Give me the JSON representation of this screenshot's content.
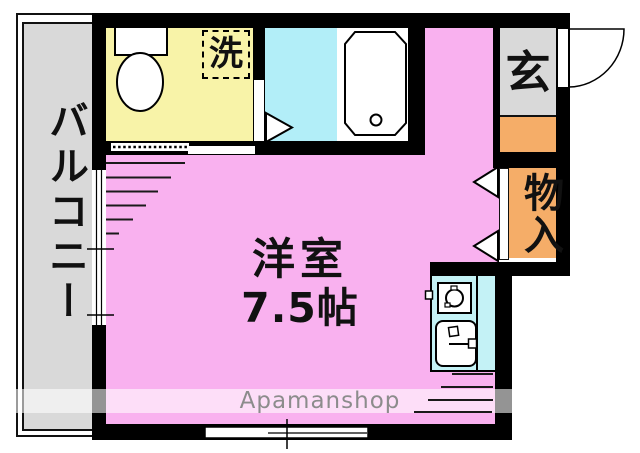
{
  "floorplan": {
    "balcony_label": "バルコニー",
    "laundry_label": "洗",
    "entrance_label": "玄",
    "closet_label": "物入",
    "room_label": "洋室",
    "room_size_label": "7.5帖",
    "watermark_label": "Apamanshop",
    "colors": {
      "room_pink": "#f9b1ef",
      "bathroom_cyan": "#b2eef8",
      "kitchen_cyan": "#c4f2f6",
      "toilet_yellow": "#f8f3a8",
      "closet_orange": "#f5ad68",
      "gray_area": "#d9d9d9",
      "wall_black": "#000000",
      "watermark_text": "#8c8c8c"
    }
  }
}
